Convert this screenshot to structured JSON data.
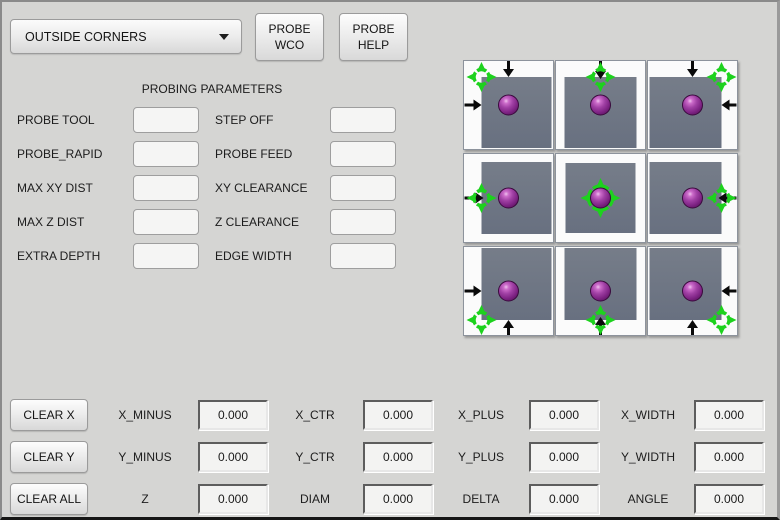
{
  "colors": {
    "background": "#d5d5d3",
    "crosshair_green": "#1dd21d",
    "ball_purple": "#932f96",
    "square_gray": "#6e7480",
    "arrow_black": "#0a0a0a"
  },
  "header": {
    "mode_select_value": "OUTSIDE CORNERS",
    "wco_line1": "PROBE",
    "wco_line2": "WCO",
    "help_line1": "PROBE",
    "help_line2": "HELP"
  },
  "parameters": {
    "title": "PROBING PARAMETERS",
    "rows": [
      {
        "l_label": "PROBE TOOL",
        "l_value": "",
        "r_label": "STEP OFF",
        "r_value": ""
      },
      {
        "l_label": "PROBE_RAPID",
        "l_value": "",
        "r_label": "PROBE FEED",
        "r_value": ""
      },
      {
        "l_label": "MAX XY DIST",
        "l_value": "",
        "r_label": "XY CLEARANCE",
        "r_value": ""
      },
      {
        "l_label": "MAX Z DIST",
        "l_value": "",
        "r_label": "Z CLEARANCE",
        "r_value": ""
      },
      {
        "l_label": "EXTRA DEPTH",
        "l_value": "",
        "r_label": "EDGE WIDTH",
        "r_value": ""
      }
    ]
  },
  "probe_grid": {
    "cells": [
      {
        "name": "top-left-corner",
        "square": {
          "t": 16,
          "l": 17,
          "r": 1,
          "b": 1
        },
        "crosshair": {
          "x": 17,
          "y": 16,
          "r": 7.5,
          "spike": 15
        },
        "ball": {
          "x": 44,
          "y": 44
        },
        "arrows": [
          {
            "dir": "down",
            "x": 44,
            "from": 0,
            "tip": 16
          },
          {
            "dir": "right",
            "y": 44,
            "from": 0,
            "tip": 17
          }
        ]
      },
      {
        "name": "top-edge",
        "square": {
          "t": 16,
          "l": 8,
          "r": 8,
          "b": 1
        },
        "crosshair": {
          "x": 44,
          "y": 16,
          "r": 7.5,
          "spike": 15
        },
        "ball": {
          "x": 44,
          "y": 44
        },
        "arrows": [
          {
            "dir": "down",
            "x": 44,
            "from": 0,
            "tip": 18
          }
        ]
      },
      {
        "name": "top-right-corner",
        "square": {
          "t": 16,
          "l": 1,
          "r": 15,
          "b": 1
        },
        "crosshair": {
          "x": 73,
          "y": 16,
          "r": 7.5,
          "spike": 15
        },
        "ball": {
          "x": 44,
          "y": 44
        },
        "arrows": [
          {
            "dir": "down",
            "x": 44,
            "from": 0,
            "tip": 16
          },
          {
            "dir": "left",
            "y": 44,
            "from": 88,
            "tip": 73
          }
        ]
      },
      {
        "name": "left-edge",
        "square": {
          "t": 8,
          "l": 17,
          "r": 1,
          "b": 8
        },
        "crosshair": {
          "x": 17,
          "y": 44,
          "r": 7.5,
          "spike": 15
        },
        "ball": {
          "x": 44,
          "y": 44
        },
        "arrows": [
          {
            "dir": "right",
            "y": 44,
            "from": 0,
            "tip": 19
          }
        ]
      },
      {
        "name": "center",
        "square": {
          "t": 9,
          "l": 9,
          "r": 9,
          "b": 9
        },
        "crosshair": {
          "x": 44,
          "y": 44,
          "r": 12,
          "spike": 20
        },
        "ball": {
          "x": 44,
          "y": 44
        },
        "arrows": []
      },
      {
        "name": "right-edge",
        "square": {
          "t": 8,
          "l": 1,
          "r": 15,
          "b": 8
        },
        "crosshair": {
          "x": 73,
          "y": 44,
          "r": 7.5,
          "spike": 15
        },
        "ball": {
          "x": 44,
          "y": 44
        },
        "arrows": [
          {
            "dir": "left",
            "y": 44,
            "from": 88,
            "tip": 70
          }
        ]
      },
      {
        "name": "bottom-left-corner",
        "square": {
          "t": 1,
          "l": 17,
          "r": 1,
          "b": 15
        },
        "crosshair": {
          "x": 17,
          "y": 73,
          "r": 7.5,
          "spike": 15
        },
        "ball": {
          "x": 44,
          "y": 44
        },
        "arrows": [
          {
            "dir": "up",
            "x": 44,
            "from": 88,
            "tip": 73
          },
          {
            "dir": "right",
            "y": 44,
            "from": 0,
            "tip": 17
          }
        ]
      },
      {
        "name": "bottom-edge",
        "square": {
          "t": 1,
          "l": 8,
          "r": 8,
          "b": 15
        },
        "crosshair": {
          "x": 44,
          "y": 73,
          "r": 7.5,
          "spike": 15
        },
        "ball": {
          "x": 44,
          "y": 44
        },
        "arrows": [
          {
            "dir": "up",
            "x": 44,
            "from": 88,
            "tip": 70
          }
        ]
      },
      {
        "name": "bottom-right-corner",
        "square": {
          "t": 1,
          "l": 1,
          "r": 15,
          "b": 15
        },
        "crosshair": {
          "x": 73,
          "y": 73,
          "r": 7.5,
          "spike": 15
        },
        "ball": {
          "x": 44,
          "y": 44
        },
        "arrows": [
          {
            "dir": "up",
            "x": 44,
            "from": 88,
            "tip": 73
          },
          {
            "dir": "left",
            "y": 44,
            "from": 88,
            "tip": 73
          }
        ]
      }
    ]
  },
  "results": {
    "clear_buttons": [
      "CLEAR X",
      "CLEAR Y",
      "CLEAR ALL"
    ],
    "rows": [
      [
        {
          "label": "X_MINUS",
          "value": "0.000"
        },
        {
          "label": "X_CTR",
          "value": "0.000"
        },
        {
          "label": "X_PLUS",
          "value": "0.000"
        },
        {
          "label": "X_WIDTH",
          "value": "0.000"
        }
      ],
      [
        {
          "label": "Y_MINUS",
          "value": "0.000"
        },
        {
          "label": "Y_CTR",
          "value": "0.000"
        },
        {
          "label": "Y_PLUS",
          "value": "0.000"
        },
        {
          "label": "Y_WIDTH",
          "value": "0.000"
        }
      ],
      [
        {
          "label": "Z",
          "value": "0.000"
        },
        {
          "label": "DIAM",
          "value": "0.000"
        },
        {
          "label": "DELTA",
          "value": "0.000"
        },
        {
          "label": "ANGLE",
          "value": "0.000"
        }
      ]
    ]
  }
}
